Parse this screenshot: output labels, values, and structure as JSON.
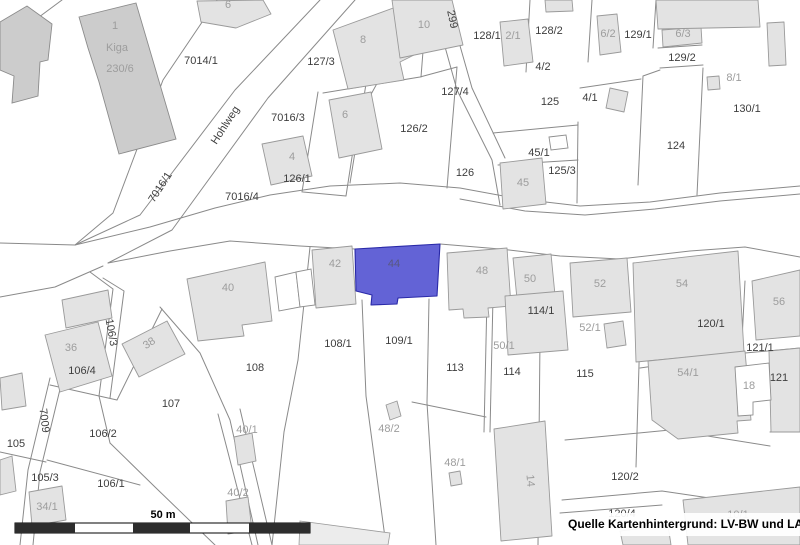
{
  "map": {
    "highlighted_parcel": "44",
    "street_name": "Hohlweg",
    "colors": {
      "highlight": "#6363d6",
      "highlight_stroke": "#2929a8",
      "building_fill": "#e3e3e3",
      "building_dark_fill": "#cccccc",
      "parcel_line": "#8a8a8a",
      "label_dark": "#3e3e3e",
      "label_light": "#9d9d9d"
    },
    "labels": [
      {
        "t": "1",
        "x": 115,
        "y": 29,
        "c": "l"
      },
      {
        "t": "Kiga",
        "x": 117,
        "y": 51,
        "c": "l",
        "fs": 12
      },
      {
        "t": "230/6",
        "x": 120,
        "y": 72,
        "c": "l",
        "fs": 12
      },
      {
        "t": "6",
        "x": 228,
        "y": 8,
        "c": "l"
      },
      {
        "t": "7014/1",
        "x": 201,
        "y": 64,
        "c": "d"
      },
      {
        "t": "127/3",
        "x": 321,
        "y": 65,
        "c": "d"
      },
      {
        "t": "8",
        "x": 363,
        "y": 43,
        "c": "l"
      },
      {
        "t": "10",
        "x": 424,
        "y": 28,
        "c": "l"
      },
      {
        "t": "299",
        "x": 449,
        "y": 20,
        "r": 78,
        "c": "d"
      },
      {
        "t": "128/1",
        "x": 487,
        "y": 39,
        "c": "d"
      },
      {
        "t": "2/1",
        "x": 513,
        "y": 39,
        "c": "l"
      },
      {
        "t": "128/2",
        "x": 549,
        "y": 34,
        "c": "d"
      },
      {
        "t": "6/2",
        "x": 608,
        "y": 37,
        "c": "l"
      },
      {
        "t": "129/1",
        "x": 638,
        "y": 38,
        "c": "d"
      },
      {
        "t": "6/3",
        "x": 683,
        "y": 37,
        "c": "l"
      },
      {
        "t": "129/2",
        "x": 682,
        "y": 61,
        "c": "d"
      },
      {
        "t": "8/1",
        "x": 734,
        "y": 81,
        "c": "l"
      },
      {
        "t": "4/2",
        "x": 543,
        "y": 70,
        "c": "d"
      },
      {
        "t": "127/4",
        "x": 455,
        "y": 95,
        "c": "d"
      },
      {
        "t": "125",
        "x": 550,
        "y": 105,
        "c": "d"
      },
      {
        "t": "4/1",
        "x": 590,
        "y": 101,
        "c": "d"
      },
      {
        "t": "130/1",
        "x": 747,
        "y": 112,
        "c": "d"
      },
      {
        "t": "Hohlweg",
        "x": 228,
        "y": 127,
        "r": -57,
        "c": "d",
        "fs": 13
      },
      {
        "t": "7016/3",
        "x": 288,
        "y": 121,
        "c": "d"
      },
      {
        "t": "6",
        "x": 345,
        "y": 118,
        "c": "l"
      },
      {
        "t": "126/2",
        "x": 414,
        "y": 132,
        "c": "d"
      },
      {
        "t": "124",
        "x": 676,
        "y": 149,
        "c": "d"
      },
      {
        "t": "45/1",
        "x": 539,
        "y": 156,
        "c": "d"
      },
      {
        "t": "4",
        "x": 292,
        "y": 160,
        "c": "l"
      },
      {
        "t": "125/3",
        "x": 562,
        "y": 174,
        "c": "d"
      },
      {
        "t": "126",
        "x": 465,
        "y": 176,
        "c": "d"
      },
      {
        "t": "126/1",
        "x": 297,
        "y": 182,
        "c": "d"
      },
      {
        "t": "45",
        "x": 523,
        "y": 186,
        "c": "l"
      },
      {
        "t": "7016/1",
        "x": 163,
        "y": 189,
        "r": -57,
        "c": "d"
      },
      {
        "t": "7016/4",
        "x": 242,
        "y": 200,
        "c": "d"
      },
      {
        "t": "42",
        "x": 335,
        "y": 267,
        "c": "l"
      },
      {
        "t": "44",
        "x": 394,
        "y": 267,
        "c": "hl"
      },
      {
        "t": "48",
        "x": 482,
        "y": 274,
        "c": "l"
      },
      {
        "t": "50",
        "x": 530,
        "y": 282,
        "c": "l"
      },
      {
        "t": "52",
        "x": 600,
        "y": 287,
        "c": "l"
      },
      {
        "t": "54",
        "x": 682,
        "y": 287,
        "c": "l"
      },
      {
        "t": "56",
        "x": 779,
        "y": 305,
        "c": "l"
      },
      {
        "t": "40",
        "x": 228,
        "y": 291,
        "c": "l"
      },
      {
        "t": "114/1",
        "x": 541,
        "y": 314,
        "c": "d"
      },
      {
        "t": "120/1",
        "x": 711,
        "y": 327,
        "c": "d"
      },
      {
        "t": "52/1",
        "x": 590,
        "y": 331,
        "c": "l"
      },
      {
        "t": "106/3",
        "x": 108,
        "y": 333,
        "r": 80,
        "c": "d"
      },
      {
        "t": "108/1",
        "x": 338,
        "y": 347,
        "c": "d"
      },
      {
        "t": "109/1",
        "x": 399,
        "y": 344,
        "c": "d"
      },
      {
        "t": "50/1",
        "x": 504,
        "y": 349,
        "c": "l"
      },
      {
        "t": "36",
        "x": 71,
        "y": 351,
        "c": "l"
      },
      {
        "t": "38",
        "x": 151,
        "y": 346,
        "r": -33,
        "c": "l"
      },
      {
        "t": "121/1",
        "x": 760,
        "y": 351,
        "c": "d"
      },
      {
        "t": "113",
        "x": 455,
        "y": 371,
        "c": "d"
      },
      {
        "t": "108",
        "x": 255,
        "y": 371,
        "c": "d"
      },
      {
        "t": "106/4",
        "x": 82,
        "y": 374,
        "c": "d"
      },
      {
        "t": "114",
        "x": 512,
        "y": 375,
        "c": "d"
      },
      {
        "t": "115",
        "x": 585,
        "y": 377,
        "c": "d"
      },
      {
        "t": "54/1",
        "x": 688,
        "y": 376,
        "c": "l"
      },
      {
        "t": "121",
        "x": 779,
        "y": 381,
        "c": "d"
      },
      {
        "t": "18",
        "x": 749,
        "y": 389,
        "c": "l"
      },
      {
        "t": "107",
        "x": 171,
        "y": 407,
        "c": "d"
      },
      {
        "t": "7009",
        "x": 41,
        "y": 421,
        "r": 83,
        "c": "d"
      },
      {
        "t": "48/2",
        "x": 389,
        "y": 432,
        "c": "l"
      },
      {
        "t": "40/1",
        "x": 247,
        "y": 433,
        "c": "l"
      },
      {
        "t": "106/2",
        "x": 103,
        "y": 437,
        "c": "d"
      },
      {
        "t": "105",
        "x": 16,
        "y": 447,
        "c": "d"
      },
      {
        "t": "48/1",
        "x": 455,
        "y": 466,
        "c": "l"
      },
      {
        "t": "14",
        "x": 527,
        "y": 481,
        "r": 85,
        "c": "l"
      },
      {
        "t": "120/2",
        "x": 625,
        "y": 480,
        "c": "d"
      },
      {
        "t": "105/3",
        "x": 45,
        "y": 481,
        "c": "d"
      },
      {
        "t": "106/1",
        "x": 111,
        "y": 487,
        "c": "d"
      },
      {
        "t": "40/2",
        "x": 238,
        "y": 496,
        "c": "l"
      },
      {
        "t": "34/1",
        "x": 47,
        "y": 510,
        "c": "l"
      },
      {
        "t": "120/4",
        "x": 622,
        "y": 517,
        "c": "d"
      },
      {
        "t": "10/1",
        "x": 738,
        "y": 518,
        "c": "l"
      }
    ]
  },
  "scale_bar": {
    "label": "50 m"
  },
  "attribution": {
    "text": "Quelle Kartenhintergrund: LV-BW und LAD"
  }
}
